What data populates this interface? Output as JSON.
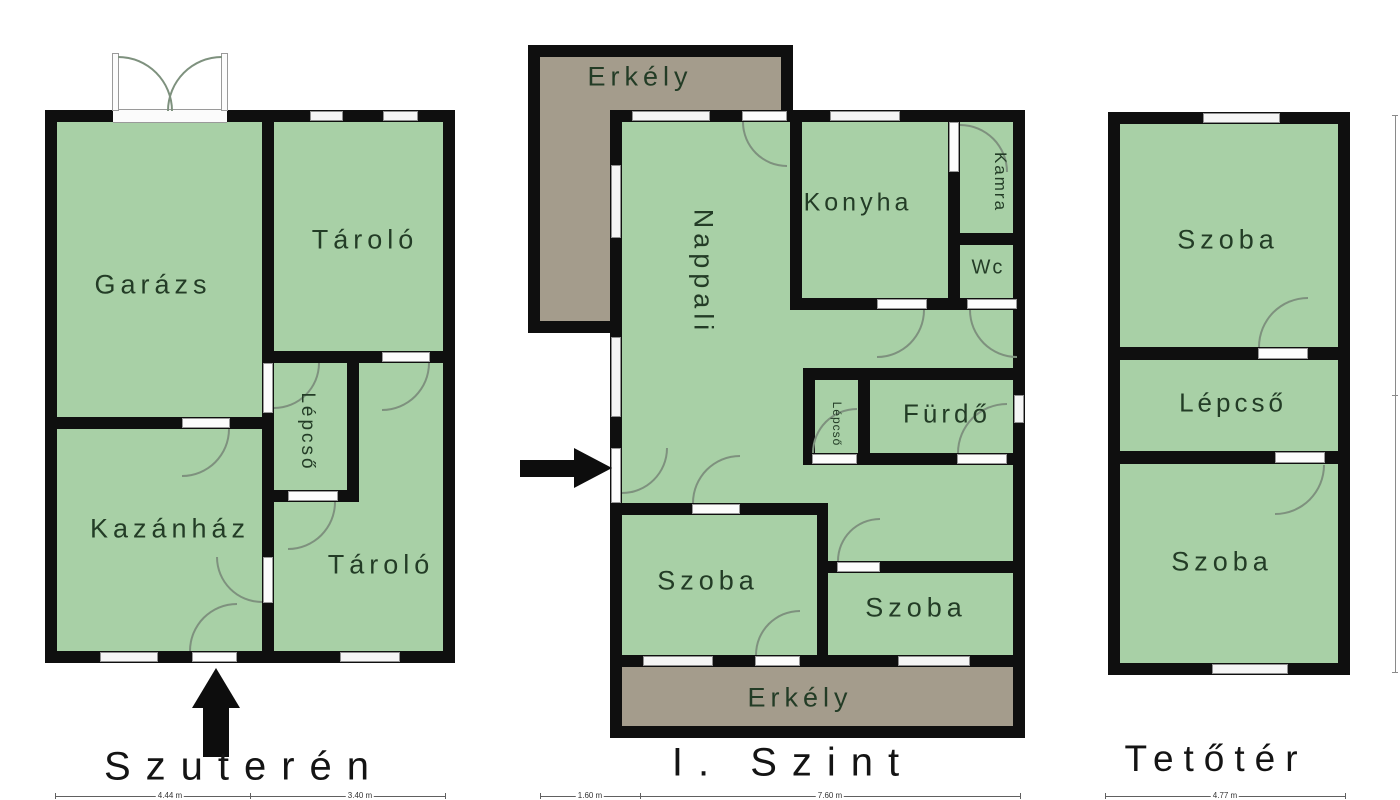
{
  "colors": {
    "room_fill": "#a8d0a6",
    "balcony_fill": "#a49c8c",
    "wall": "#0f0f0f",
    "window_fill": "#f5f5f5",
    "door_swing": "#7e917e",
    "room_label": "#233c26",
    "title": "#141414"
  },
  "plans": [
    {
      "title": "Szuterén",
      "rooms": [
        {
          "label": "Garázs"
        },
        {
          "label": "Tároló"
        },
        {
          "label": "Lépcső"
        },
        {
          "label": "Kazánház"
        },
        {
          "label": "Tároló"
        }
      ]
    },
    {
      "title": "I. Szint",
      "rooms": [
        {
          "label": "Erkély"
        },
        {
          "label": "Nappali"
        },
        {
          "label": "Konyha"
        },
        {
          "label": "Kamra"
        },
        {
          "label": "Wc"
        },
        {
          "label": "Lépcső"
        },
        {
          "label": "Fürdő"
        },
        {
          "label": "Szoba"
        },
        {
          "label": "Szoba"
        },
        {
          "label": "Erkély"
        }
      ]
    },
    {
      "title": "Tetőtér",
      "rooms": [
        {
          "label": "Szoba"
        },
        {
          "label": "Lépcső"
        },
        {
          "label": "Szoba"
        }
      ]
    }
  ],
  "dimensions": {
    "szuteren": [
      "4.44 m",
      "3.40 m"
    ],
    "szint": [
      "1.60 m",
      "7.60 m"
    ],
    "tetoter": [
      "4.77 m"
    ]
  }
}
